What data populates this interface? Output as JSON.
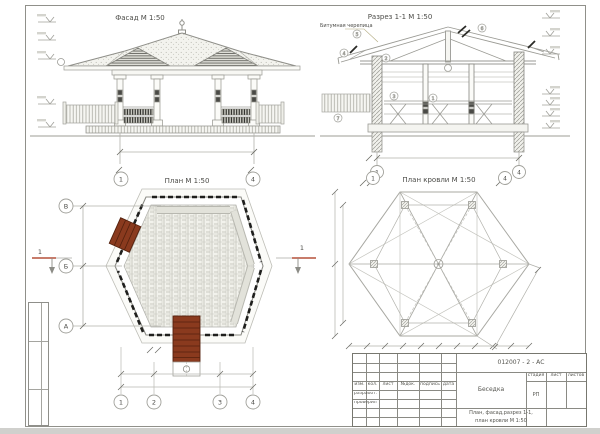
{
  "drawing": {
    "facade": {
      "title": "Фасад М 1:50"
    },
    "section": {
      "title": "Разрез 1-1 М 1:50",
      "material_label": "Битумная черепица",
      "axis_bubbles": [
        "1",
        "4"
      ],
      "callouts": [
        "5",
        "4",
        "2",
        "6",
        "1",
        "3",
        "7"
      ]
    },
    "plan": {
      "title": "План М 1:50",
      "top_bubbles": [
        "1",
        "4"
      ],
      "row_bubbles": [
        "В",
        "Б",
        "А"
      ],
      "col_bubbles": [
        "1",
        "2",
        "3",
        "4"
      ],
      "section_cut_label": "1"
    },
    "roof_plan": {
      "title": "План кровли М 1:50",
      "axis_bubbles": [
        "1",
        "4"
      ]
    }
  },
  "title_block": {
    "doc_code": "012007 - 2 - АС",
    "revision_headers": [
      "изм.",
      "кол.",
      "лист",
      "№док.",
      "подпись",
      "дата"
    ],
    "roles": [
      "разработ.",
      "проверил"
    ],
    "project_name": "Беседка",
    "stage_label": "стадия",
    "sheet_label": "лист",
    "sheets_label": "листов",
    "stage_value": "РП",
    "sheet_title_line1": "План, фасад,разрез 1-1,",
    "sheet_title_line2": "план кровли М 1:50"
  },
  "colors": {
    "stair_brown": "#8a3a1e",
    "section_cut_red": "#b5503a",
    "line_gray": "#9a9a94",
    "railing_black": "#1f1f1d",
    "bench_gray": "#ddddd4"
  }
}
